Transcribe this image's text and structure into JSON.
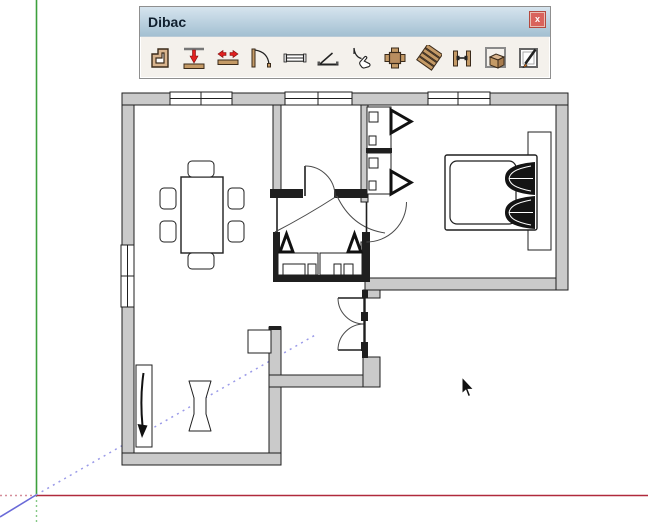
{
  "window": {
    "title": "Dibac",
    "close_label": "x"
  },
  "toolbar": {
    "tools": [
      {
        "name": "draw-walls",
        "icon": "wall-corner-icon"
      },
      {
        "name": "wall-height",
        "icon": "wall-push-down-icon"
      },
      {
        "name": "wall-offset",
        "icon": "wall-stretch-arrows-icon"
      },
      {
        "name": "doors",
        "icon": "door-swing-icon"
      },
      {
        "name": "windows",
        "icon": "window-plan-icon"
      },
      {
        "name": "casement-window",
        "icon": "window-open-icon"
      },
      {
        "name": "interactive-door",
        "icon": "hand-door-icon"
      },
      {
        "name": "furniture",
        "icon": "table-chairs-icon"
      },
      {
        "name": "stairs",
        "icon": "stairs-icon"
      },
      {
        "name": "wall-junction",
        "icon": "wall-joint-icon"
      },
      {
        "name": "generate-3d",
        "icon": "box-3d-icon"
      },
      {
        "name": "convert-2d-3d",
        "icon": "pen-document-icon"
      }
    ]
  },
  "colors": {
    "titlebar_top": "#d6e4ee",
    "titlebar_bottom": "#a3c0d2",
    "toolbar_bg": "#f4f1ec",
    "close_bg": "#d9635c",
    "wall_fill": "#cacaca",
    "wall_stroke": "#1f1f1f",
    "axis_red": "#b02a3c",
    "axis_green": "#3ca03c",
    "axis_blue": "#6a6ad8"
  },
  "cursor": {
    "x": 462,
    "y": 377
  },
  "floorplan": {
    "rooms": [
      "living-dining-room",
      "hallway",
      "bathroom",
      "bedroom",
      "kitchen-lounge"
    ],
    "furniture": [
      "dining-table",
      "six-chairs",
      "wardrobe-open-doors",
      "double-bed",
      "pillows",
      "bathroom-cabinets",
      "tall-cabinet",
      "side-unit",
      "stool"
    ]
  }
}
